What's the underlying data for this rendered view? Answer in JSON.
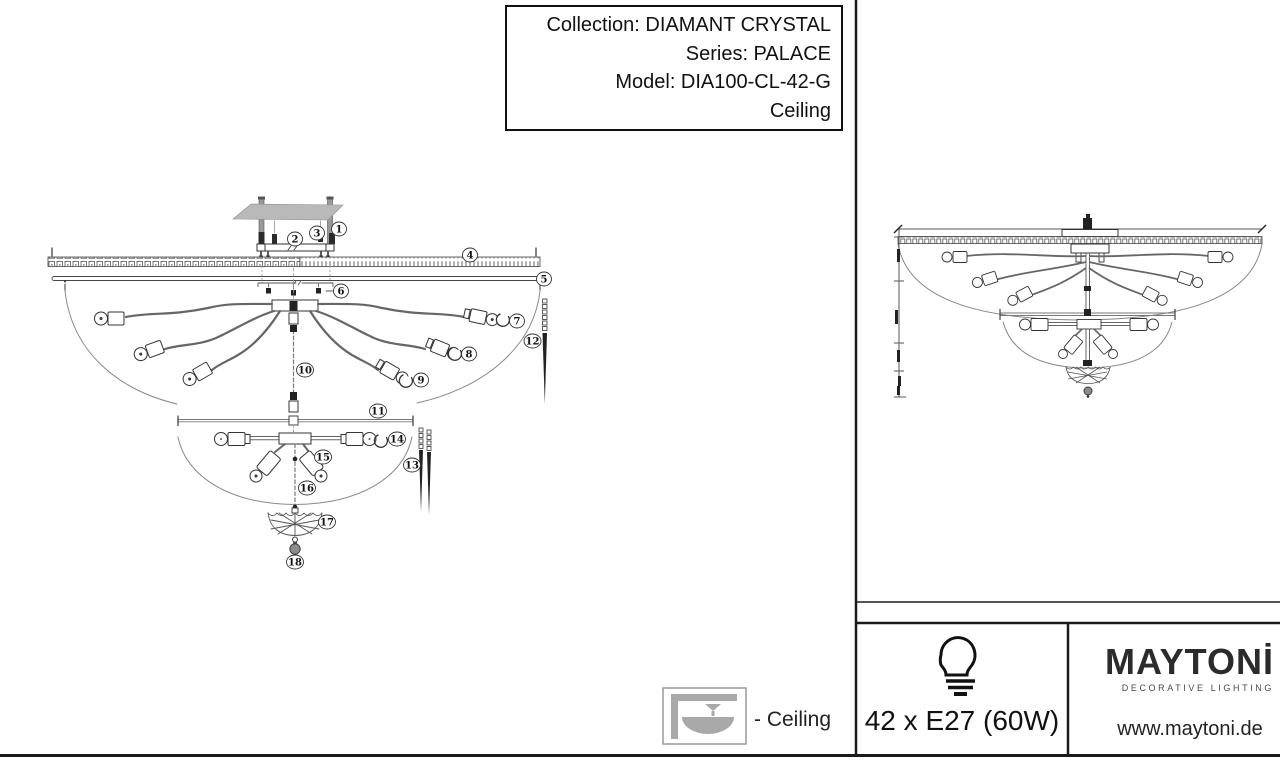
{
  "title_box": {
    "collection": "Collection: DIAMANT CRYSTAL",
    "series": "Series: PALACE",
    "model": "Model: DIA100-CL-42-G",
    "mount_type": "Ceiling"
  },
  "part_labels": {
    "p1": "1",
    "p2": "2",
    "p3": "3",
    "p4": "4",
    "p5": "5",
    "p6": "6",
    "p7": "7",
    "p8": "8",
    "p9": "9",
    "p10": "10",
    "p11": "11",
    "p12": "12",
    "p13": "13",
    "p14": "14",
    "p15": "15",
    "p16": "16",
    "p17": "17",
    "p18": "18"
  },
  "legend": {
    "ceiling": "- Ceiling"
  },
  "spec": {
    "lamps": "42 x E27 (60W)"
  },
  "brand": {
    "logo": "MAYTONİ",
    "tagline": "DECORATIVE LIGHTING",
    "website": "www.maytoni.de"
  },
  "colors": {
    "line": "#333333",
    "light_line": "#888888",
    "plate": "#b9b9b9",
    "icon_gray": "#a9a9a9"
  }
}
